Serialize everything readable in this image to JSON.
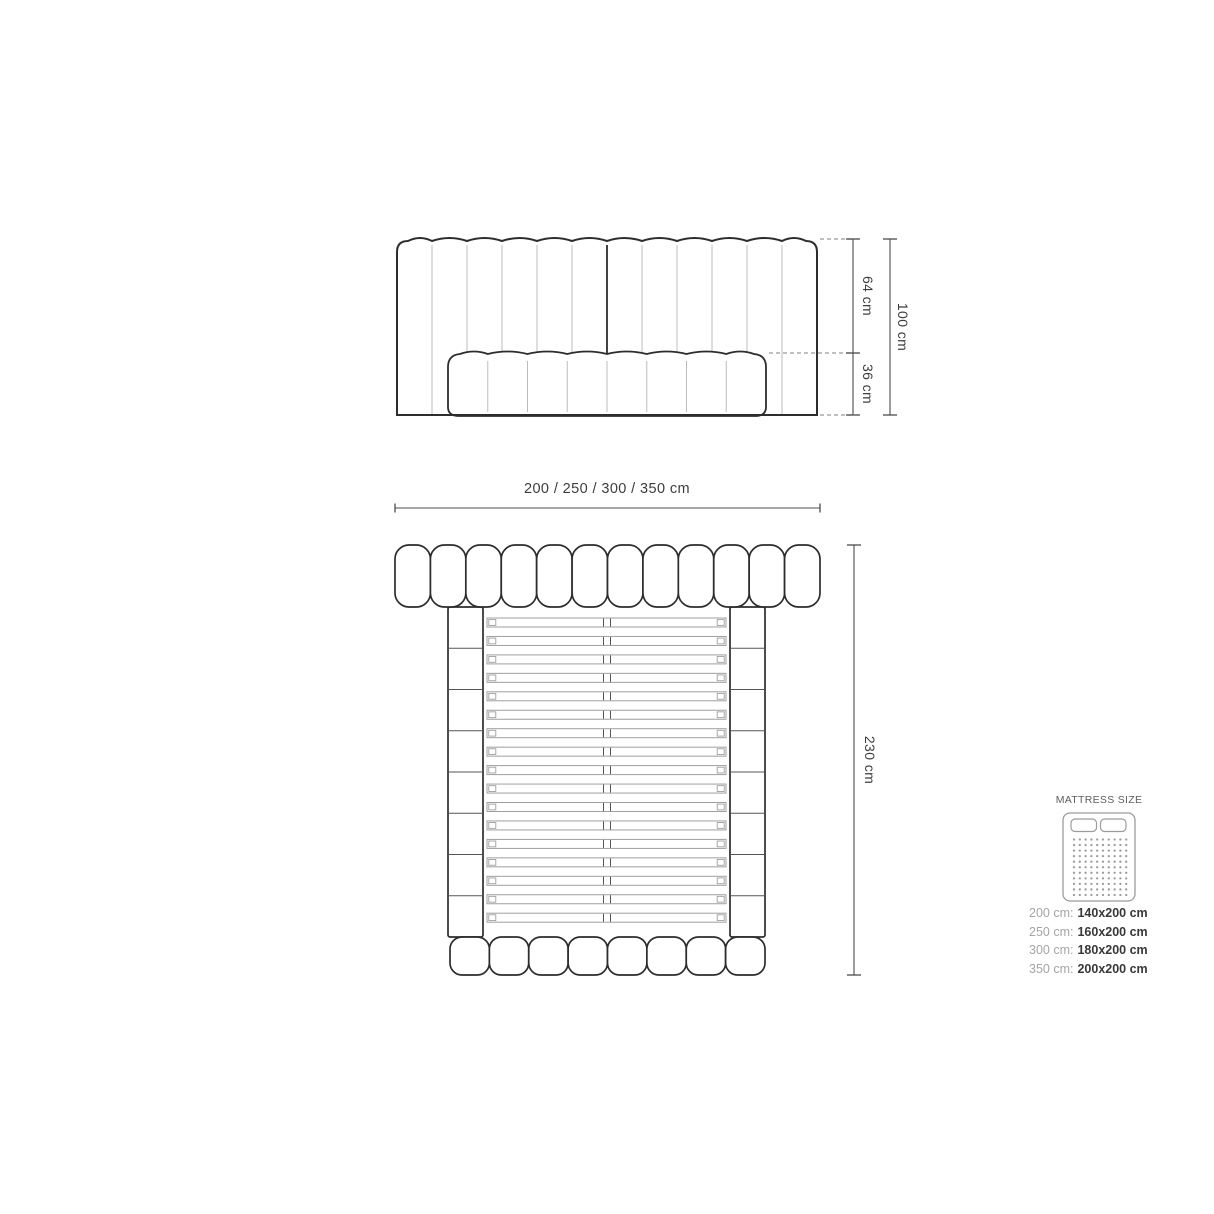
{
  "diagram": {
    "front_view": {
      "channels": 12,
      "lower_panel_segments": 8,
      "dim_upper": "64 cm",
      "dim_lower": "36 cm",
      "dim_total": "100 cm"
    },
    "top_view": {
      "headboard_segments": 12,
      "rail_segments_per_side": 8,
      "slats": 17,
      "footboard_segments": 8,
      "dim_width": "200 / 250 / 300 / 350 cm",
      "dim_length": "230 cm"
    }
  },
  "mattress_panel": {
    "title": "MATTRESS SIZE",
    "icon": "mattress-icon",
    "sizes": [
      {
        "frame": "200 cm:",
        "mattress": "140x200 cm"
      },
      {
        "frame": "250 cm:",
        "mattress": "160x200 cm"
      },
      {
        "frame": "300 cm:",
        "mattress": "180x200 cm"
      },
      {
        "frame": "350 cm:",
        "mattress": "200x200 cm"
      }
    ]
  },
  "colors": {
    "outline": "#2d2d2d",
    "light_line": "#bcbcbc",
    "mid_line": "#555555",
    "slat_line": "#9f9f9f",
    "dim_line": "#4c4c4c",
    "dashed_line": "#9a9a9a",
    "dim_text": "#3d3d3d",
    "muted_text": "#a5a5a5",
    "value_text": "#383838",
    "icon_line": "#9c9c9c",
    "title_text": "#5d5d5d",
    "background": "#ffffff"
  }
}
